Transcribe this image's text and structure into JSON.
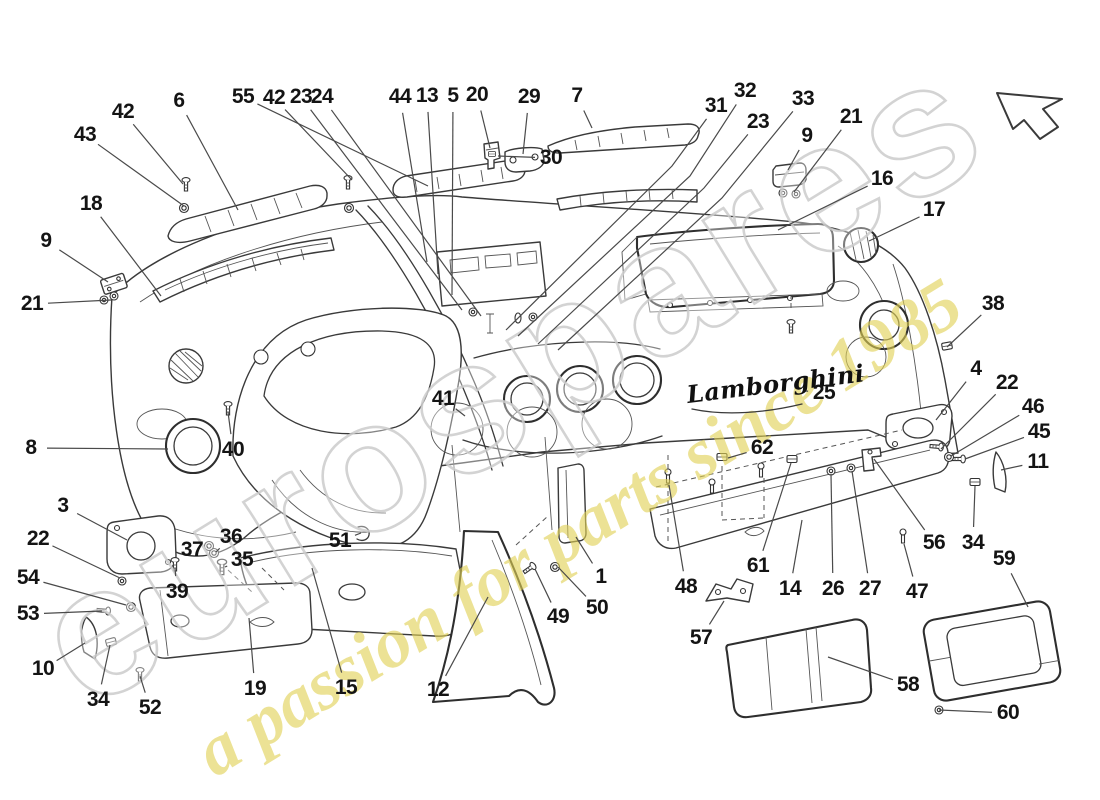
{
  "page": {
    "background": "#ffffff",
    "line_color": "#3a3a3a",
    "label_color": "#141414"
  },
  "watermark": {
    "brand": "eurospares",
    "tagline": "a passion for parts since 1985",
    "brand_outline_color": "#cbcbcb",
    "tagline_color": "#e0d154"
  },
  "logo": {
    "text": "Lamborghini"
  },
  "icons": {
    "direction_arrow": "arrow-up-left"
  },
  "diagram": {
    "callouts": [
      {
        "n": "42",
        "x": 123,
        "y": 112,
        "tx": 183,
        "ty": 184
      },
      {
        "n": "43",
        "x": 85,
        "y": 135,
        "tx": 184,
        "ty": 206
      },
      {
        "n": "6",
        "x": 179,
        "y": 101,
        "tx": 238,
        "ty": 210
      },
      {
        "n": "55",
        "x": 243,
        "y": 97,
        "tx": 428,
        "ty": 186
      },
      {
        "n": "42",
        "x": 274,
        "y": 98,
        "tx": 352,
        "ty": 180
      },
      {
        "n": "23",
        "x": 301,
        "y": 97,
        "tx": 462,
        "ty": 310
      },
      {
        "n": "24",
        "x": 322,
        "y": 97,
        "tx": 481,
        "ty": 316
      },
      {
        "n": "44",
        "x": 400,
        "y": 97,
        "tx": 427,
        "ty": 262
      },
      {
        "n": "13",
        "x": 427,
        "y": 96,
        "tx": 438,
        "ty": 274
      },
      {
        "n": "5",
        "x": 453,
        "y": 96,
        "tx": 452,
        "ty": 295
      },
      {
        "n": "20",
        "x": 477,
        "y": 95,
        "tx": 490,
        "ty": 148
      },
      {
        "n": "29",
        "x": 529,
        "y": 97,
        "tx": 523,
        "ty": 154
      },
      {
        "n": "7",
        "x": 577,
        "y": 96,
        "tx": 592,
        "ty": 128
      },
      {
        "n": "30",
        "x": 551,
        "y": 158,
        "tx": 498,
        "ty": 156
      },
      {
        "n": "31",
        "x": 716,
        "y": 106,
        "tx": 506,
        "ty": 330,
        "via": [
          672,
          166
        ]
      },
      {
        "n": "32",
        "x": 745,
        "y": 91,
        "tx": 518,
        "ty": 336,
        "via": [
          690,
          176
        ]
      },
      {
        "n": "23",
        "x": 758,
        "y": 122,
        "tx": 538,
        "ty": 344,
        "via": [
          704,
          188
        ]
      },
      {
        "n": "33",
        "x": 803,
        "y": 99,
        "tx": 558,
        "ty": 350,
        "via": [
          722,
          198
        ]
      },
      {
        "n": "9",
        "x": 807,
        "y": 136,
        "tx": 788,
        "ty": 170
      },
      {
        "n": "21",
        "x": 851,
        "y": 117,
        "tx": 794,
        "ty": 192
      },
      {
        "n": "16",
        "x": 882,
        "y": 179,
        "tx": 778,
        "ty": 230
      },
      {
        "n": "17",
        "x": 934,
        "y": 210,
        "tx": 869,
        "ty": 241
      },
      {
        "n": "38",
        "x": 993,
        "y": 304,
        "tx": 947,
        "ty": 347
      },
      {
        "n": "4",
        "x": 976,
        "y": 369,
        "tx": 936,
        "ty": 420
      },
      {
        "n": "22",
        "x": 1007,
        "y": 383,
        "tx": 941,
        "ty": 449
      },
      {
        "n": "46",
        "x": 1033,
        "y": 407,
        "tx": 951,
        "ty": 456
      },
      {
        "n": "45",
        "x": 1039,
        "y": 432,
        "tx": 965,
        "ty": 459
      },
      {
        "n": "11",
        "x": 1038,
        "y": 462,
        "tx": 1001,
        "ty": 470
      },
      {
        "n": "18",
        "x": 91,
        "y": 204,
        "tx": 161,
        "ty": 296
      },
      {
        "n": "9",
        "x": 46,
        "y": 241,
        "tx": 108,
        "ty": 282
      },
      {
        "n": "21",
        "x": 32,
        "y": 304,
        "tx": 111,
        "ty": 300
      },
      {
        "n": "8",
        "x": 31,
        "y": 448,
        "tx": 168,
        "ty": 449
      },
      {
        "n": "3",
        "x": 63,
        "y": 506,
        "tx": 127,
        "ty": 540
      },
      {
        "n": "22",
        "x": 38,
        "y": 539,
        "tx": 120,
        "ty": 578
      },
      {
        "n": "54",
        "x": 28,
        "y": 578,
        "tx": 126,
        "ty": 605
      },
      {
        "n": "53",
        "x": 28,
        "y": 614,
        "tx": 102,
        "ty": 611
      },
      {
        "n": "10",
        "x": 43,
        "y": 669,
        "tx": 85,
        "ty": 643
      },
      {
        "n": "34",
        "x": 98,
        "y": 700,
        "tx": 110,
        "ty": 645
      },
      {
        "n": "52",
        "x": 150,
        "y": 708,
        "tx": 140,
        "ty": 676
      },
      {
        "n": "39",
        "x": 177,
        "y": 592,
        "tx": 175,
        "ty": 568
      },
      {
        "n": "37",
        "x": 192,
        "y": 550,
        "tx": 207,
        "ty": 547
      },
      {
        "n": "36",
        "x": 231,
        "y": 537,
        "tx": 216,
        "ty": 552
      },
      {
        "n": "35",
        "x": 242,
        "y": 560,
        "tx": 225,
        "ty": 567
      },
      {
        "n": "40",
        "x": 233,
        "y": 450,
        "tx": 228,
        "ty": 412
      },
      {
        "n": "41",
        "x": 443,
        "y": 399,
        "tx": 465,
        "ty": 416
      },
      {
        "n": "51",
        "x": 340,
        "y": 541,
        "tx": 361,
        "ty": 533
      },
      {
        "n": "19",
        "x": 255,
        "y": 689,
        "tx": 249,
        "ty": 618
      },
      {
        "n": "15",
        "x": 346,
        "y": 688,
        "tx": 312,
        "ty": 568
      },
      {
        "n": "12",
        "x": 438,
        "y": 690,
        "tx": 488,
        "ty": 597
      },
      {
        "n": "25",
        "x": 824,
        "y": 393,
        "tx": 806,
        "ty": 391
      },
      {
        "n": "1",
        "x": 601,
        "y": 577,
        "tx": 576,
        "ty": 537
      },
      {
        "n": "50",
        "x": 597,
        "y": 608,
        "tx": 558,
        "ty": 567
      },
      {
        "n": "49",
        "x": 558,
        "y": 617,
        "tx": 535,
        "ty": 569
      },
      {
        "n": "48",
        "x": 686,
        "y": 587,
        "tx": 669,
        "ty": 485
      },
      {
        "n": "57",
        "x": 701,
        "y": 638,
        "tx": 724,
        "ty": 601
      },
      {
        "n": "62",
        "x": 762,
        "y": 448,
        "tx": 728,
        "ty": 458
      },
      {
        "n": "61",
        "x": 758,
        "y": 566,
        "tx": 791,
        "ty": 463
      },
      {
        "n": "14",
        "x": 790,
        "y": 589,
        "tx": 802,
        "ty": 520
      },
      {
        "n": "26",
        "x": 833,
        "y": 589,
        "tx": 831,
        "ty": 474
      },
      {
        "n": "27",
        "x": 870,
        "y": 589,
        "tx": 852,
        "ty": 471
      },
      {
        "n": "47",
        "x": 917,
        "y": 592,
        "tx": 904,
        "ty": 544
      },
      {
        "n": "56",
        "x": 934,
        "y": 543,
        "tx": 874,
        "ty": 459
      },
      {
        "n": "34",
        "x": 973,
        "y": 543,
        "tx": 975,
        "ty": 486
      },
      {
        "n": "59",
        "x": 1004,
        "y": 559,
        "tx": 1028,
        "ty": 607
      },
      {
        "n": "58",
        "x": 908,
        "y": 685,
        "tx": 828,
        "ty": 657
      },
      {
        "n": "60",
        "x": 1008,
        "y": 713,
        "tx": 939,
        "ty": 710
      }
    ]
  }
}
